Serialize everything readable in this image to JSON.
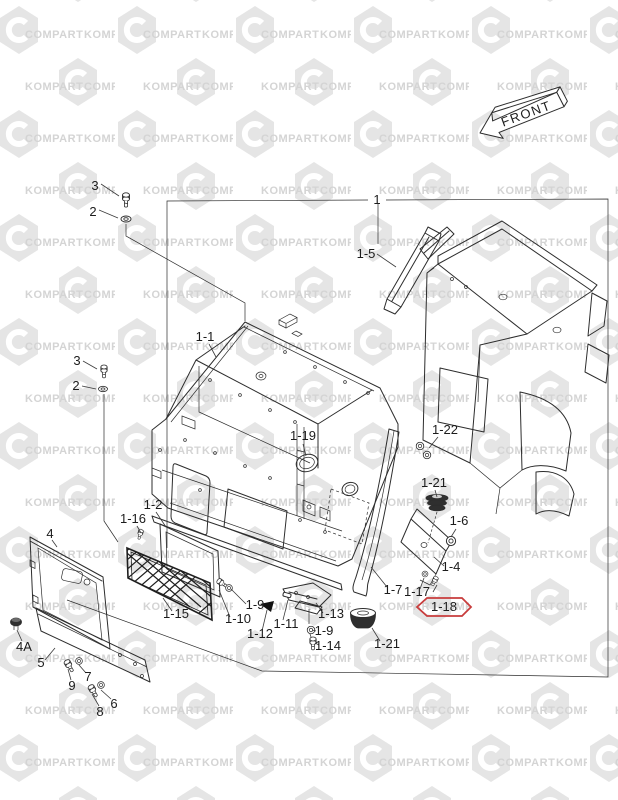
{
  "page": {
    "width": 618,
    "height": 800,
    "background": "#ffffff"
  },
  "watermark": {
    "word_a": "COMPART",
    "word_b": "KOMPART",
    "hex_color": "#e5e5e5",
    "text_color": "#d4d4d4"
  },
  "front_badge": {
    "label": "FRONT"
  },
  "diagram": {
    "assembly_label": "1",
    "line_color": "#2d2d2d",
    "highlight": {
      "label": "1-18",
      "color": "#c83c3c"
    },
    "callouts": [
      {
        "id": "3a",
        "text": "3",
        "label": [
          95,
          190
        ],
        "leader": [
          101,
          184,
          119,
          196
        ]
      },
      {
        "id": "2a",
        "text": "2",
        "label": [
          93,
          216
        ],
        "leader": [
          99,
          210,
          118,
          218
        ]
      },
      {
        "id": "1",
        "text": "1",
        "label": [
          377,
          204
        ],
        "leader": null
      },
      {
        "id": "1-5",
        "text": "1-5",
        "label": [
          366,
          258
        ],
        "leader": [
          377,
          254,
          396,
          267
        ]
      },
      {
        "id": "1-1",
        "text": "1-1",
        "label": [
          205,
          341
        ],
        "leader": [
          209,
          344,
          216,
          357
        ]
      },
      {
        "id": "1-19",
        "text": "1-19",
        "label": [
          303,
          440
        ],
        "leader": [
          303,
          444,
          306,
          456
        ]
      },
      {
        "id": "1-22",
        "text": "1-22",
        "label": [
          445,
          434
        ],
        "leader": [
          438,
          437,
          429,
          448
        ]
      },
      {
        "id": "1-21u",
        "text": "1-21",
        "label": [
          434,
          487
        ],
        "leader": [
          435,
          490,
          437,
          497
        ]
      },
      {
        "id": "1-6",
        "text": "1-6",
        "label": [
          459,
          525
        ],
        "leader": [
          456,
          529,
          451,
          537
        ]
      },
      {
        "id": "1-4",
        "text": "1-4",
        "label": [
          451,
          571
        ],
        "leader": [
          444,
          566,
          434,
          557
        ]
      },
      {
        "id": "3b",
        "text": "3",
        "label": [
          77,
          365
        ],
        "leader": [
          83,
          361,
          97,
          369
        ]
      },
      {
        "id": "2b",
        "text": "2",
        "label": [
          76,
          390
        ],
        "leader": [
          82,
          386,
          96,
          389
        ]
      },
      {
        "id": "1-2",
        "text": "1-2",
        "label": [
          153,
          509
        ],
        "leader": [
          156,
          512,
          166,
          527
        ]
      },
      {
        "id": "1-16",
        "text": "1-16",
        "label": [
          133,
          523
        ],
        "leader": [
          137,
          526,
          141,
          533
        ]
      },
      {
        "id": "1-7",
        "text": "1-7",
        "label": [
          393,
          594
        ],
        "leader": [
          387,
          587,
          371,
          567
        ]
      },
      {
        "id": "1-17",
        "text": "1-17",
        "label": [
          417,
          596
        ],
        "leader": [
          420,
          589,
          424,
          578
        ],
        "leader2": [
          433,
          592,
          437,
          585
        ]
      },
      {
        "id": "1-15",
        "text": "1-15",
        "label": [
          176,
          618
        ],
        "leader": [
          172,
          611,
          163,
          598
        ]
      },
      {
        "id": "1-9a",
        "text": "1-9",
        "label": [
          255,
          609
        ],
        "leader": [
          246,
          604,
          231,
          589
        ]
      },
      {
        "id": "1-10",
        "text": "1-10",
        "label": [
          238,
          623
        ],
        "leader": [
          230,
          617,
          219,
          590
        ]
      },
      {
        "id": "1-11",
        "text": "1-11",
        "label": [
          286,
          628
        ],
        "leader": [
          283,
          620,
          288,
          600
        ]
      },
      {
        "id": "1-12",
        "text": "1-12",
        "label": [
          260,
          638
        ],
        "leader": [
          262,
          631,
          267,
          610
        ]
      },
      {
        "id": "1-13",
        "text": "1-13",
        "label": [
          331,
          618
        ],
        "leader": [
          323,
          613,
          316,
          603
        ]
      },
      {
        "id": "1-9b",
        "text": "1-9",
        "label": [
          324,
          635
        ],
        "leader": [
          316,
          631,
          312,
          630
        ]
      },
      {
        "id": "1-14",
        "text": "1-14",
        "label": [
          328,
          650
        ],
        "leader": [
          319,
          645,
          315,
          643
        ]
      },
      {
        "id": "1-21l",
        "text": "1-21",
        "label": [
          387,
          648
        ],
        "leader": [
          380,
          641,
          372,
          628
        ]
      },
      {
        "id": "4",
        "text": "4",
        "label": [
          50,
          538
        ],
        "leader": [
          52,
          540,
          57,
          547
        ]
      },
      {
        "id": "4A",
        "text": "4A",
        "label": [
          24,
          651
        ],
        "leader": [
          22,
          641,
          17,
          630
        ]
      },
      {
        "id": "5",
        "text": "5",
        "label": [
          41,
          667
        ],
        "leader": [
          45,
          660,
          55,
          648
        ]
      },
      {
        "id": "9",
        "text": "9",
        "label": [
          72,
          690
        ],
        "leader": [
          71,
          680,
          68,
          669
        ]
      },
      {
        "id": "7",
        "text": "7",
        "label": [
          88,
          681
        ],
        "leader": [
          86,
          673,
          79,
          665
        ]
      },
      {
        "id": "8",
        "text": "8",
        "label": [
          100,
          716
        ],
        "leader": [
          99,
          706,
          92,
          694
        ]
      },
      {
        "id": "6",
        "text": "6",
        "label": [
          114,
          708
        ],
        "leader": [
          111,
          699,
          101,
          690
        ]
      }
    ]
  }
}
